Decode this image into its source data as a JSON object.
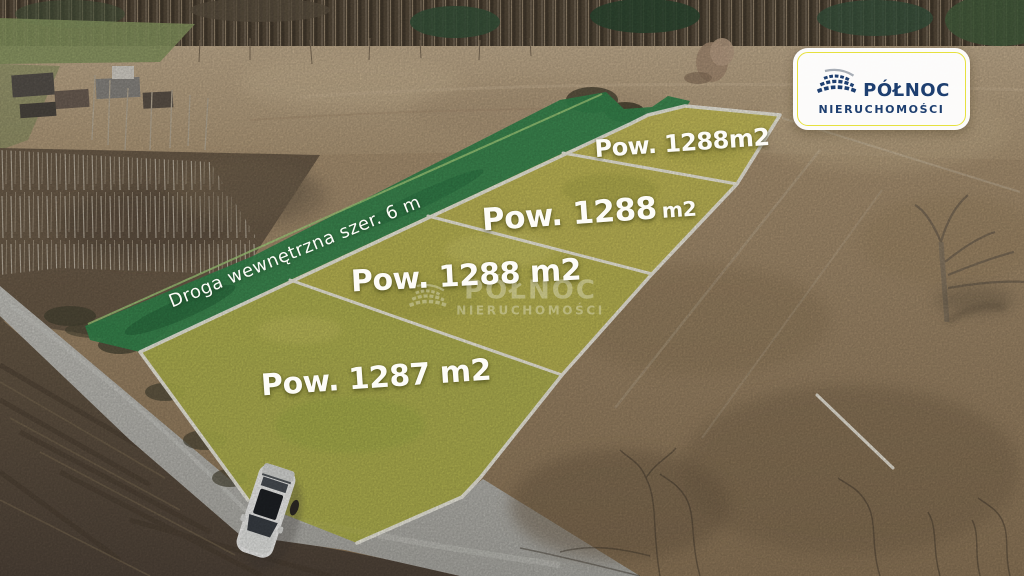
{
  "branding": {
    "name_line1": "PÓŁNOC",
    "name_line2": "NIERUCHOMOŚCI"
  },
  "watermark": {
    "name_line1": "PÓŁNOC",
    "name_line2": "NIERUCHOMOŚCI"
  },
  "annotations": {
    "road_label": "Droga wewnętrzna szer. 6 m",
    "plot_labels": {
      "plot1": "Pow. 1288m2",
      "plot2_main": "Pow. 1288",
      "plot2_unit": "m2",
      "plot3": "Pow. 1288 m2",
      "plot4": "Pow. 1287 m2"
    }
  },
  "colors": {
    "accent-navy": "#1e3f70",
    "badge-yellow": "#e6e13e",
    "label-white": "#fdfcf7",
    "parcel-highlight": "#c5bf58",
    "road-overlay-green": "#35884f",
    "boundary-white": "#f6f3e9"
  }
}
